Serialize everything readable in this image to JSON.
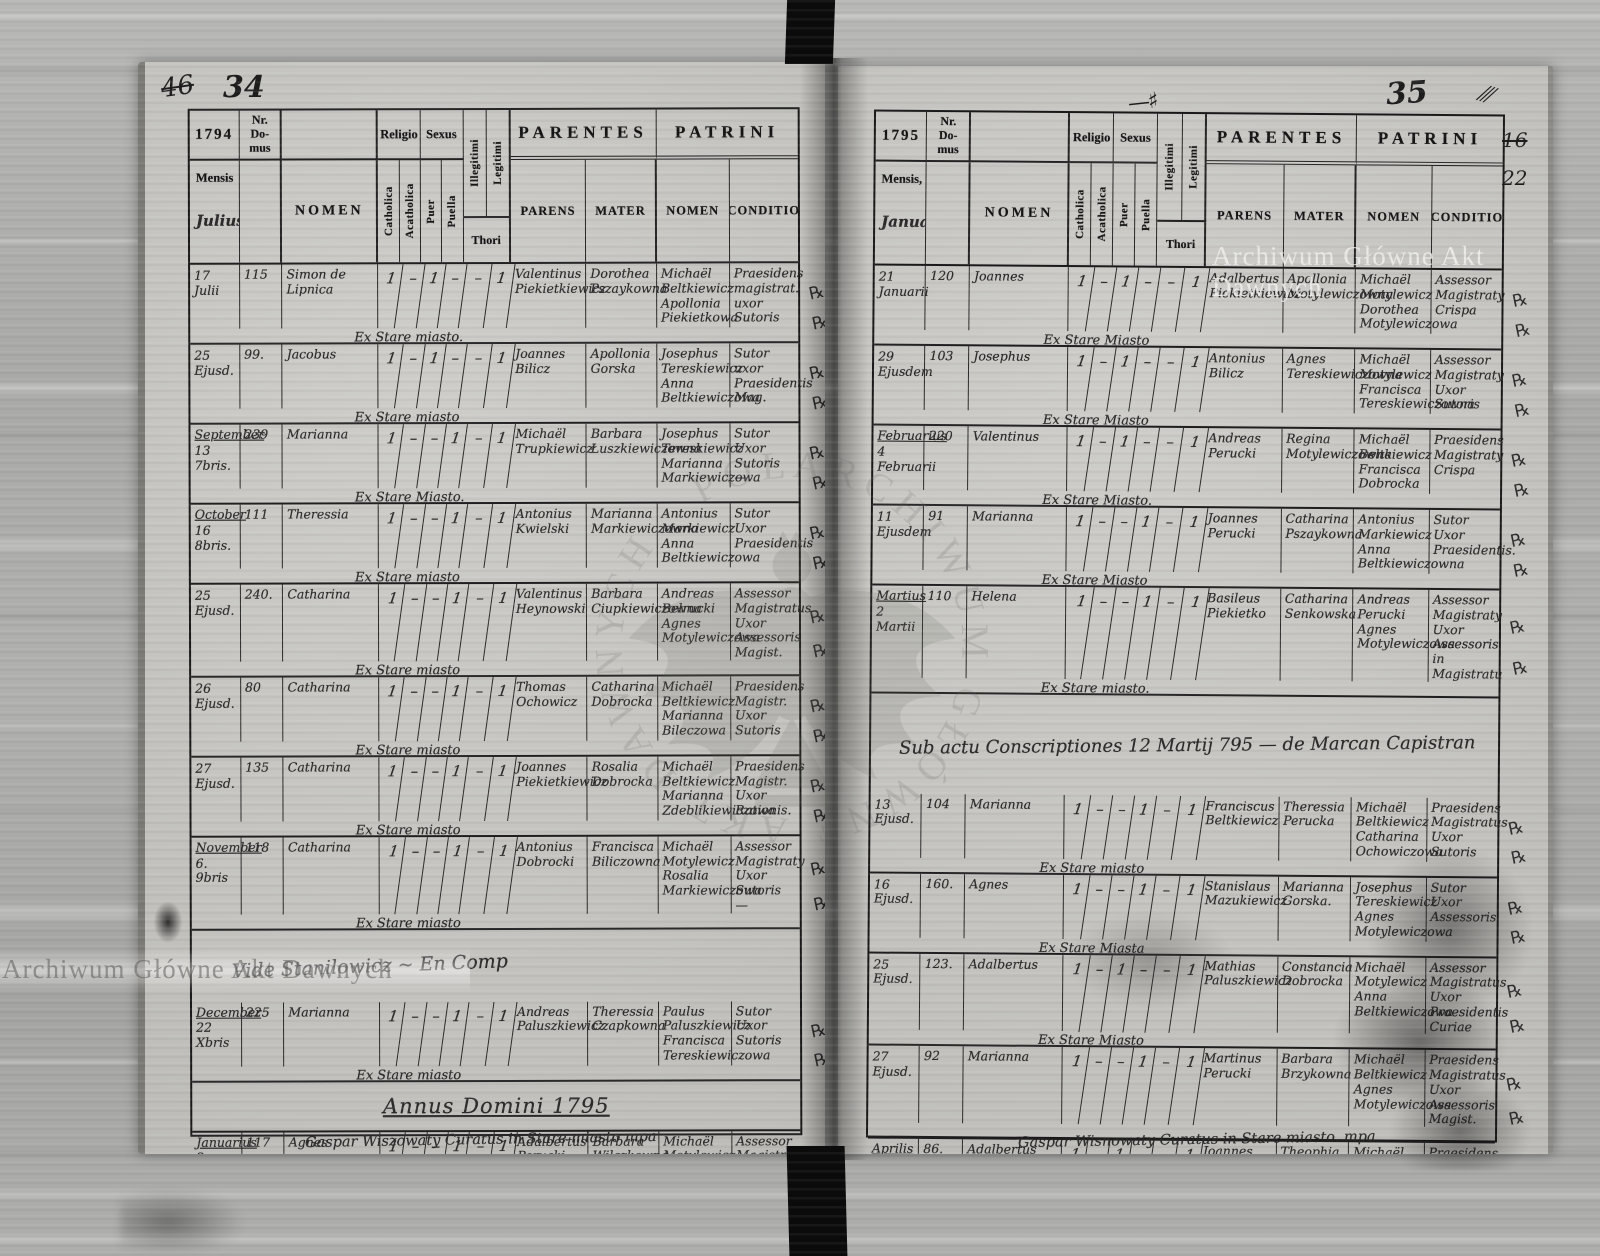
{
  "document": {
    "watermark_text": "Archiwum Główne Akt Dawnych",
    "margin_mark_glyph": "℞",
    "colors": {
      "paper": "#c6c5c1",
      "ink": "#1c1c1c",
      "spine": "#0b0b0b"
    },
    "header": {
      "nr_domus": "Nr.\nDo-\nmus",
      "nomen": "NOMEN",
      "religio": "Religio",
      "sexus": "Sexus",
      "catholica": "Catholica",
      "acatholica": "Acatholica",
      "puer": "Puer",
      "puella": "Puella",
      "illegitimi": "Illegitimi",
      "legitimi": "Legitimi",
      "thori": "Thori",
      "parentes": "PARENTES",
      "patrini": "PATRINI",
      "parens": "PARENS",
      "mater": "MATER",
      "nomen2": "NOMEN",
      "conditio": "CONDITIO"
    },
    "page_left": {
      "folio_old": "46",
      "folio": "34",
      "year": "1794",
      "mensis_label": "Mensis",
      "month": "Julius",
      "bottom_note": "Gaspar Wiszowaty Curatus in Stare miasto mpa",
      "rows": [
        {
          "date": "17 Julii",
          "nr": "115",
          "name": "Simon de Lipnica",
          "cath": "1",
          "acath": "–",
          "puer": "1",
          "puella": "–",
          "illeg": "–",
          "legit": "1",
          "parens": "Valentinus Piekietkiewicz",
          "mater": "Dorothea Pszaykowna",
          "patrini": "Michaël Beltkiewicz Apollonia Piekietkowa",
          "conditio": "Praesidens magistrat. uxor Sutoris",
          "note": "Ex Stare miasto."
        },
        {
          "date": "25 Ejusd.",
          "nr": "99.",
          "name": "Jacobus",
          "cath": "1",
          "acath": "–",
          "puer": "1",
          "puella": "–",
          "illeg": "–",
          "legit": "1",
          "parens": "Joannes Bilicz",
          "mater": "Apollonia Gorska",
          "patrini": "Josephus Tereskiewicz Anna Beltkiewiczowa",
          "conditio": "Sutor uxor Praesidentis Mag.",
          "note": "Ex Stare miasto"
        },
        {
          "month": "September",
          "date": "13 7bris.",
          "nr": "239",
          "name": "Marianna",
          "cath": "1",
          "acath": "–",
          "puer": "–",
          "puella": "1",
          "illeg": "–",
          "legit": "1",
          "parens": "Michaël Trupkiewicz",
          "mater": "Barbara Łuszkiewiczowna",
          "patrini": "Josephus Tereskiewicz Marianna Markiewiczowa",
          "conditio": "Sutor Uxor Sutoris —",
          "note": "Ex Stare Miasto."
        },
        {
          "month": "October",
          "date": "16 8bris.",
          "nr": "111",
          "name": "Theressia",
          "cath": "1",
          "acath": "–",
          "puer": "–",
          "puella": "1",
          "illeg": "–",
          "legit": "1",
          "parens": "Antonius Kwielski",
          "mater": "Marianna Markiewiczowna",
          "patrini": "Antonius Markiewicz Anna Beltkiewiczowa",
          "conditio": "Sutor Uxor Praesidentis",
          "note": "Ex Stare miasto"
        },
        {
          "date": "25 Ejusd.",
          "nr": "240.",
          "name": "Catharina",
          "cath": "1",
          "acath": "–",
          "puer": "–",
          "puella": "1",
          "illeg": "–",
          "legit": "1",
          "parens": "Valentinus Heynowski",
          "mater": "Barbara Ciupkiewiczowna",
          "patrini": "Andreas Bełrucki Agnes Motylewiczowa",
          "conditio": "Assessor Magistratus Uxor Assessoris Magist.",
          "note": "Ex Stare miasto"
        },
        {
          "date": "26 Ejusd.",
          "nr": "80",
          "name": "Catharina",
          "cath": "1",
          "acath": "–",
          "puer": "–",
          "puella": "1",
          "illeg": "–",
          "legit": "1",
          "parens": "Thomas Ochowicz",
          "mater": "Catharina Dobrocka",
          "patrini": "Michaël Beltkiewicz Marianna Bileczowa",
          "conditio": "Praesidens Magistr. Uxor Sutoris",
          "note": "Ex Stare miasto"
        },
        {
          "date": "27 Ejusd.",
          "nr": "135",
          "name": "Catharina",
          "cath": "1",
          "acath": "–",
          "puer": "–",
          "puella": "1",
          "illeg": "–",
          "legit": "1",
          "parens": "Joannes Piekietkiewicz",
          "mater": "Rosalia Dobrocka",
          "patrini": "Michaël Beltkiewicz Marianna Zdeblikiewiczowa",
          "conditio": "Praesidens Magistr. Uxor Rationis.",
          "note": "Ex Stare miasto"
        },
        {
          "month": "November",
          "date": "6. 9bris",
          "nr": "118",
          "name": "Catharina",
          "cath": "1",
          "acath": "–",
          "puer": "–",
          "puella": "1",
          "illeg": "–",
          "legit": "1",
          "parens": "Antonius Dobrocki",
          "mater": "Francisca Biliczowna",
          "patrini": "Michaël Motylewicz Rosalia Markiewiczowa",
          "conditio": "Assessor Magistraty Uxor Sutoris —",
          "note": "Ex Stare miasto"
        },
        {
          "type": "annotation",
          "text": "Vide Stanilowicz ~ En Comp"
        },
        {
          "month": "December",
          "date": "22 Xbris",
          "nr": "225",
          "name": "Marianna",
          "cath": "1",
          "acath": "–",
          "puer": "–",
          "puella": "1",
          "illeg": "–",
          "legit": "1",
          "parens": "Andreas Paluszkiewicz",
          "mater": "Theressia Czapkowna",
          "patrini": "Paulus Paluszkiewicz Francisca Tereskiewiczowa",
          "conditio": "Sutor Uxor Sutoris",
          "note": "Ex Stare miasto"
        },
        {
          "type": "section",
          "text": "Annus Domini 1795"
        },
        {
          "month": "Januarius",
          "date": "2 Januarii",
          "nr": "117",
          "name": "Agnes",
          "name_note": "Gemini",
          "cath": "1",
          "acath": "–",
          "puer": "–",
          "puella": "1",
          "illeg": "–",
          "legit": "1",
          "parens": "Adalbertus Perucki",
          "mater": "Barbara Wilczkowna",
          "patrini": "Michaël Motylewicz Marianna Biliczowa",
          "conditio": "Assessor Magistraty Uxor Sartoris",
          "note": "Ex Stare miasto"
        },
        {
          "date": "Eodem",
          "nr": "117",
          "name": "Marianna",
          "cath": "1",
          "acath": "–",
          "puer": "–",
          "puella": "1",
          "illeg": "–",
          "legit": "1",
          "parens": "Idem",
          "mater": "Eadem",
          "patrini": "Michaël Beltkiewicz Francisca Tereskiewiczowa",
          "conditio": "Praesidens magistr. Uxor Sutoris",
          "note": "Ex Stare miasto."
        }
      ]
    },
    "page_right": {
      "folio": "35",
      "flourish": "—♯",
      "hash": "⫻",
      "margin_no_old": "16",
      "margin_no": "22",
      "year": "1795",
      "mensis_label": "Mensis,",
      "month": "Januarius",
      "bottom_note": "Gaspar Wisnowaty Curatus in Stare miasto. mpa",
      "rows": [
        {
          "date": "21 Januarii",
          "nr": "120",
          "name": "Joannes",
          "cath": "1",
          "acath": "–",
          "puer": "1",
          "puella": "–",
          "illeg": "–",
          "legit": "1",
          "parens": "Adalbertus Piekietkiewicz",
          "mater": "Apollonia Motylewiczowna",
          "patrini": "Michaël Motylewicz Dorothea Motylewiczowa",
          "conditio": "Assessor Magistraty Crispa",
          "note": "Ex Stare Miasto"
        },
        {
          "date": "29 Ejusdem",
          "nr": "103",
          "name": "Josephus",
          "cath": "1",
          "acath": "–",
          "puer": "1",
          "puella": "–",
          "illeg": "–",
          "legit": "1",
          "parens": "Antonius Bilicz",
          "mater": "Agnes Tereskiewiczowna",
          "patrini": "Michaël Motylewicz Francisca Tereskiewiczowna",
          "conditio": "Assessor Magistraty Uxor Sutoris",
          "note": "Ex Stare Miasto"
        },
        {
          "month": "Februarius",
          "date": "4 Februarii",
          "nr": "220",
          "name": "Valentinus",
          "cath": "1",
          "acath": "–",
          "puer": "1",
          "puella": "–",
          "illeg": "–",
          "legit": "1",
          "parens": "Andreas Perucki",
          "mater": "Regina Motylewiczowna",
          "patrini": "Michaël Beltkiewicz Francisca Dobrocka",
          "conditio": "Praesidens Magistraty Crispa",
          "note": "Ex Stare Miasto."
        },
        {
          "date": "11 Ejusdem",
          "nr": "91",
          "name": "Marianna",
          "cath": "1",
          "acath": "–",
          "puer": "–",
          "puella": "1",
          "illeg": "–",
          "legit": "1",
          "parens": "Joannes Perucki",
          "mater": "Catharina Pszaykowna",
          "patrini": "Antonius Markiewicz Anna Beltkiewiczowna",
          "conditio": "Sutor Uxor Praesidentis.",
          "note": "Ex Stare Miasto"
        },
        {
          "month": "Martius",
          "date": "2 Martii",
          "nr": "110",
          "name": "Helena",
          "cath": "1",
          "acath": "–",
          "puer": "–",
          "puella": "1",
          "illeg": "–",
          "legit": "1",
          "parens": "Basileus Piekietko",
          "mater": "Catharina Senkowska",
          "patrini": "Andreas Perucki Agnes Motylewiczowa",
          "conditio": "Assessor Magistraty Uxor Assessoris in Magistratu",
          "note": "Ex Stare miasto."
        },
        {
          "type": "span_note",
          "text": "Sub actu Conscriptiones 12 Martij 795 — de Marcan Capistran"
        },
        {
          "date": "13 Ejusd.",
          "nr": "104",
          "name": "Marianna",
          "cath": "1",
          "acath": "–",
          "puer": "–",
          "puella": "1",
          "illeg": "–",
          "legit": "1",
          "parens": "Franciscus Beltkiewicz",
          "mater": "Theressia Perucka",
          "patrini": "Michaël Beltkiewicz Catharina Ochowiczowa",
          "conditio": "Praesidens Magistratus Uxor Sutoris",
          "note": "Ex Stare miasto"
        },
        {
          "date": "16 Ejusd.",
          "nr": "160.",
          "name": "Agnes",
          "cath": "1",
          "acath": "–",
          "puer": "–",
          "puella": "1",
          "illeg": "–",
          "legit": "1",
          "parens": "Stanislaus Mazukiewicz",
          "mater": "Marianna Gorska.",
          "patrini": "Josephus Tereskiewicz Agnes Motylewiczowa",
          "conditio": "Sutor Uxor Assessoris",
          "note": "Ex Stare Miasta"
        },
        {
          "date": "25 Ejusd.",
          "nr": "123.",
          "name": "Adalbertus",
          "cath": "1",
          "acath": "–",
          "puer": "1",
          "puella": "–",
          "illeg": "–",
          "legit": "1",
          "parens": "Mathias Paluszkiewicz",
          "mater": "Constancia Dobrocka",
          "patrini": "Michaël Motylewicz Anna Beltkiewiczowa",
          "conditio": "Assessor Magistratus. Uxor Praesidentis Curiae",
          "note": "Ex Stare Miasto"
        },
        {
          "date": "27 Ejusd.",
          "nr": "92",
          "name": "Marianna",
          "cath": "1",
          "acath": "–",
          "puer": "–",
          "puella": "1",
          "illeg": "–",
          "legit": "1",
          "parens": "Martinus Perucki",
          "mater": "Barbara Brzykowna",
          "patrini": "Michaël Beltkiewicz Agnes Motylewiczowa",
          "conditio": "Praesidens Magistratus Uxor Assessoris Magist.",
          "note": ""
        },
        {
          "month": "Aprilis",
          "date": "3. Aprilis",
          "nr": "86.",
          "name": "Adalbertus",
          "cath": "1",
          "acath": "–",
          "puer": "1",
          "puella": "–",
          "illeg": "–",
          "legit": "1",
          "parens": "Joannes Motylewicz",
          "mater": "Theophia Biliczowna",
          "patrini": "Michaël Beltkiewicz Marianna Zdechlikiewiczowa",
          "conditio": "Praesidens Magistr. Uxor Lanii",
          "note": "Ex Stare Miasto."
        },
        {
          "date": "27. Ejusd.",
          "nr": "121",
          "name": "Jacobus",
          "cath": "1",
          "acath": "–",
          "puer": "1",
          "puella": "–",
          "illeg": "–",
          "legit": "1",
          "parens": "Gregorius Piekietko",
          "mater": "Marianna Paluszkiewiczowna",
          "patrini": "Michaël Motylewicz Agnes Biliczowa",
          "conditio": "Assessor Magistr. Uxor",
          "note": "Ex Stare miasto."
        }
      ]
    }
  }
}
